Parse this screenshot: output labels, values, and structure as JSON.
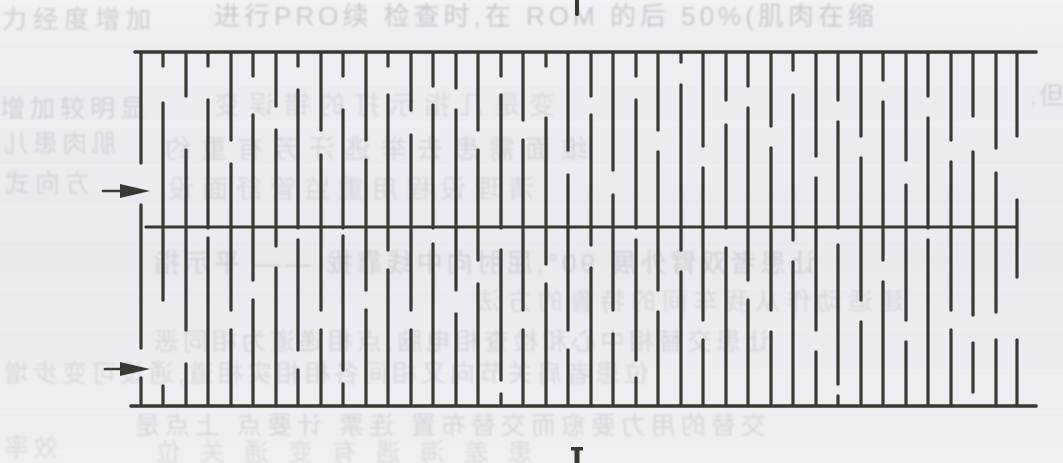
{
  "page": {
    "bg": "#eeedf1",
    "ink": "#3b3733",
    "bleed_color": "#8f8d99",
    "description": "scanned textbook page with comb-pattern line diagram"
  },
  "bleed_rows": [
    {
      "name": "top-left-note",
      "text": "力经度增加",
      "x": 2,
      "y": 8,
      "size": 25,
      "ls": 6,
      "op": 0.34,
      "mir": false
    },
    {
      "name": "header-line",
      "text": "进行PRO续 检查时,在 ROM 的后 50%(肌肉在缩",
      "x": 214,
      "y": 3,
      "size": 26,
      "ls": 4,
      "op": 0.4,
      "mir": false
    },
    {
      "name": "right-fragment",
      "text": ",但",
      "x": 1030,
      "y": 84,
      "size": 25,
      "ls": 2,
      "op": 0.3,
      "mir": false
    },
    {
      "name": "left-note-2",
      "text": "增加较明显",
      "x": 0,
      "y": 97,
      "size": 25,
      "ls": 5,
      "op": 0.3,
      "mir": false
    },
    {
      "name": "ghost-row-1",
      "text": "变是几指示打的错误变",
      "x": 205,
      "y": 92,
      "size": 26,
      "ls": 9,
      "op": 0.2,
      "mir": true
    },
    {
      "name": "left-ghost-1",
      "text": "肌肉患儿",
      "x": 0,
      "y": 132,
      "size": 25,
      "ls": 4,
      "op": 0.26,
      "mir": true
    },
    {
      "name": "ghost-row-2",
      "text": "维面需患去举逃汗芳有重约",
      "x": 155,
      "y": 136,
      "size": 26,
      "ls": 10,
      "op": 0.22,
      "mir": true
    },
    {
      "name": "left-ghost-2",
      "text": "方向式",
      "x": 0,
      "y": 172,
      "size": 25,
      "ls": 5,
      "op": 0.26,
      "mir": true
    },
    {
      "name": "ghost-row-3",
      "text": "清理设程用重监管舒面设",
      "x": 160,
      "y": 176,
      "size": 26,
      "ls": 8,
      "op": 0.2,
      "mir": true
    },
    {
      "name": "ghost-row-4",
      "text": "让患者双臂外展 90°,屈肘向中线靠拢 —— 平示指",
      "x": 150,
      "y": 250,
      "size": 26,
      "ls": 4,
      "op": 0.26,
      "mir": true
    },
    {
      "name": "ghost-row-5",
      "text": "建适动作从我车间的特鲁的方法",
      "x": 470,
      "y": 290,
      "size": 25,
      "ls": 6,
      "op": 0.19,
      "mir": true
    },
    {
      "name": "ghost-row-6",
      "text": "让患交替相中心和检查相电脑,点相递道为相同恶",
      "x": 150,
      "y": 330,
      "size": 25,
      "ls": 4,
      "op": 0.23,
      "mir": true
    },
    {
      "name": "ghost-row-7",
      "text": "位患者肩关节向又相间各相相实相道,通设可变步增",
      "x": 0,
      "y": 362,
      "size": 25,
      "ls": 4,
      "op": 0.21,
      "mir": true
    },
    {
      "name": "ghost-row-8",
      "text": "交替的用力要愈而交替布置 连票 计要点 上点是",
      "x": 130,
      "y": 414,
      "size": 25,
      "ls": 5,
      "op": 0.25,
      "mir": true
    },
    {
      "name": "ghost-row-9",
      "text": "患 差 海 遇 有 变 通 关 位",
      "x": 150,
      "y": 441,
      "size": 25,
      "ls": 6,
      "op": 0.2,
      "mir": true
    },
    {
      "name": "bottom-left-ghost",
      "text": "效率",
      "x": 0,
      "y": 436,
      "size": 25,
      "ls": 4,
      "op": 0.2,
      "mir": true
    }
  ],
  "figure": {
    "stroke": 3.2,
    "top_line": {
      "y": 52,
      "x1": 135,
      "x2": 1036
    },
    "middle_line": {
      "y": 227,
      "x1": 146,
      "x2": 1017
    },
    "bottom_line": {
      "y": 406,
      "x1": 131,
      "x2": 1036
    },
    "arrows": [
      {
        "name": "upper-pointer",
        "tail_x": 103,
        "tip_x": 150,
        "y": 191
      },
      {
        "name": "lower-pointer",
        "tail_x": 105,
        "tip_x": 150,
        "y": 369
      }
    ],
    "top_tick": {
      "x": 577,
      "y1": 0,
      "y2": 14,
      "w": 4
    },
    "bottom_glyph": {
      "x": 577,
      "y": 447,
      "label": "I"
    },
    "columns": [
      {
        "x": 141,
        "segments": [
          [
            52,
            163
          ],
          [
            205,
            348
          ],
          [
            378,
            406
          ]
        ]
      },
      {
        "x": 163,
        "segments": [
          [
            52,
            66
          ],
          [
            103,
            300
          ],
          [
            386,
            406
          ]
        ]
      },
      {
        "x": 186,
        "segments": [
          [
            52,
            96
          ],
          [
            150,
            330
          ],
          [
            364,
            406
          ]
        ]
      },
      {
        "x": 208,
        "segments": [
          [
            52,
            66
          ],
          [
            100,
            228
          ],
          [
            238,
            406
          ]
        ]
      },
      {
        "x": 231,
        "segments": [
          [
            52,
            140
          ],
          [
            164,
            310
          ],
          [
            330,
            406
          ]
        ]
      },
      {
        "x": 253,
        "segments": [
          [
            52,
            76
          ],
          [
            115,
            280
          ],
          [
            300,
            406
          ]
        ]
      },
      {
        "x": 276,
        "segments": [
          [
            52,
            106
          ],
          [
            130,
            246
          ],
          [
            268,
            406
          ]
        ]
      },
      {
        "x": 298,
        "segments": [
          [
            52,
            66
          ],
          [
            90,
            228
          ],
          [
            240,
            350
          ],
          [
            370,
            406
          ]
        ]
      },
      {
        "x": 321,
        "segments": [
          [
            52,
            130
          ],
          [
            155,
            310
          ],
          [
            330,
            406
          ]
        ]
      },
      {
        "x": 343,
        "segments": [
          [
            52,
            76
          ],
          [
            110,
            228
          ],
          [
            236,
            370
          ],
          [
            384,
            406
          ]
        ]
      },
      {
        "x": 366,
        "segments": [
          [
            52,
            140
          ],
          [
            160,
            290
          ],
          [
            310,
            406
          ]
        ]
      },
      {
        "x": 388,
        "segments": [
          [
            52,
            66
          ],
          [
            95,
            250
          ],
          [
            270,
            406
          ]
        ]
      },
      {
        "x": 411,
        "segments": [
          [
            52,
            110
          ],
          [
            135,
            310
          ],
          [
            330,
            406
          ]
        ]
      },
      {
        "x": 433,
        "segments": [
          [
            52,
            86
          ],
          [
            105,
            228
          ],
          [
            244,
            406
          ]
        ]
      },
      {
        "x": 456,
        "segments": [
          [
            52,
            88
          ],
          [
            110,
            290
          ],
          [
            314,
            406
          ]
        ]
      },
      {
        "x": 478,
        "segments": [
          [
            52,
            130
          ],
          [
            150,
            260
          ],
          [
            284,
            406
          ]
        ]
      },
      {
        "x": 501,
        "segments": [
          [
            52,
            76
          ],
          [
            95,
            228
          ],
          [
            250,
            380
          ],
          [
            394,
            406
          ]
        ]
      },
      {
        "x": 523,
        "segments": [
          [
            52,
            120
          ],
          [
            140,
            310
          ],
          [
            330,
            406
          ]
        ]
      },
      {
        "x": 546,
        "segments": [
          [
            52,
            66
          ],
          [
            118,
            264
          ],
          [
            284,
            406
          ]
        ]
      },
      {
        "x": 568,
        "segments": [
          [
            52,
            150
          ],
          [
            175,
            330
          ],
          [
            350,
            406
          ]
        ]
      },
      {
        "x": 591,
        "segments": [
          [
            52,
            96
          ],
          [
            115,
            245
          ],
          [
            268,
            406
          ]
        ]
      },
      {
        "x": 613,
        "segments": [
          [
            52,
            170
          ],
          [
            195,
            310
          ],
          [
            334,
            406
          ]
        ]
      },
      {
        "x": 636,
        "segments": [
          [
            52,
            76
          ],
          [
            100,
            228
          ],
          [
            240,
            360
          ],
          [
            378,
            406
          ]
        ]
      },
      {
        "x": 658,
        "segments": [
          [
            52,
            130
          ],
          [
            152,
            290
          ],
          [
            312,
            406
          ]
        ]
      },
      {
        "x": 681,
        "segments": [
          [
            52,
            62
          ],
          [
            85,
            250
          ],
          [
            272,
            406
          ]
        ]
      },
      {
        "x": 703,
        "segments": [
          [
            52,
            146
          ],
          [
            168,
            320
          ],
          [
            340,
            406
          ]
        ]
      },
      {
        "x": 726,
        "segments": [
          [
            52,
            100
          ],
          [
            125,
            228
          ],
          [
            248,
            406
          ]
        ]
      },
      {
        "x": 748,
        "segments": [
          [
            52,
            86
          ],
          [
            108,
            280
          ],
          [
            300,
            406
          ]
        ]
      },
      {
        "x": 771,
        "segments": [
          [
            52,
            126
          ],
          [
            148,
            310
          ],
          [
            332,
            406
          ]
        ]
      },
      {
        "x": 793,
        "segments": [
          [
            52,
            70
          ],
          [
            95,
            240
          ],
          [
            262,
            406
          ]
        ]
      },
      {
        "x": 816,
        "segments": [
          [
            52,
            156
          ],
          [
            178,
            330
          ],
          [
            352,
            406
          ]
        ]
      },
      {
        "x": 838,
        "segments": [
          [
            52,
            100
          ],
          [
            122,
            228
          ],
          [
            245,
            384
          ],
          [
            396,
            406
          ]
        ]
      },
      {
        "x": 861,
        "segments": [
          [
            52,
            136
          ],
          [
            158,
            300
          ],
          [
            322,
            406
          ]
        ]
      },
      {
        "x": 883,
        "segments": [
          [
            52,
            80
          ],
          [
            102,
            260
          ],
          [
            282,
            406
          ]
        ]
      },
      {
        "x": 906,
        "segments": [
          [
            52,
            160
          ],
          [
            185,
            320
          ],
          [
            342,
            406
          ]
        ]
      },
      {
        "x": 928,
        "segments": [
          [
            52,
            96
          ],
          [
            118,
            228
          ],
          [
            240,
            406
          ]
        ]
      },
      {
        "x": 951,
        "segments": [
          [
            52,
            140
          ],
          [
            162,
            310
          ],
          [
            330,
            406
          ]
        ]
      },
      {
        "x": 973,
        "segments": [
          [
            52,
            116
          ],
          [
            152,
            315
          ],
          [
            343,
            392
          ]
        ]
      },
      {
        "x": 996,
        "segments": [
          [
            52,
            148
          ],
          [
            173,
            312
          ],
          [
            340,
            406
          ]
        ]
      },
      {
        "x": 1017,
        "segments": [
          [
            52,
            136
          ],
          [
            200,
            277
          ],
          [
            340,
            406
          ]
        ]
      }
    ]
  }
}
